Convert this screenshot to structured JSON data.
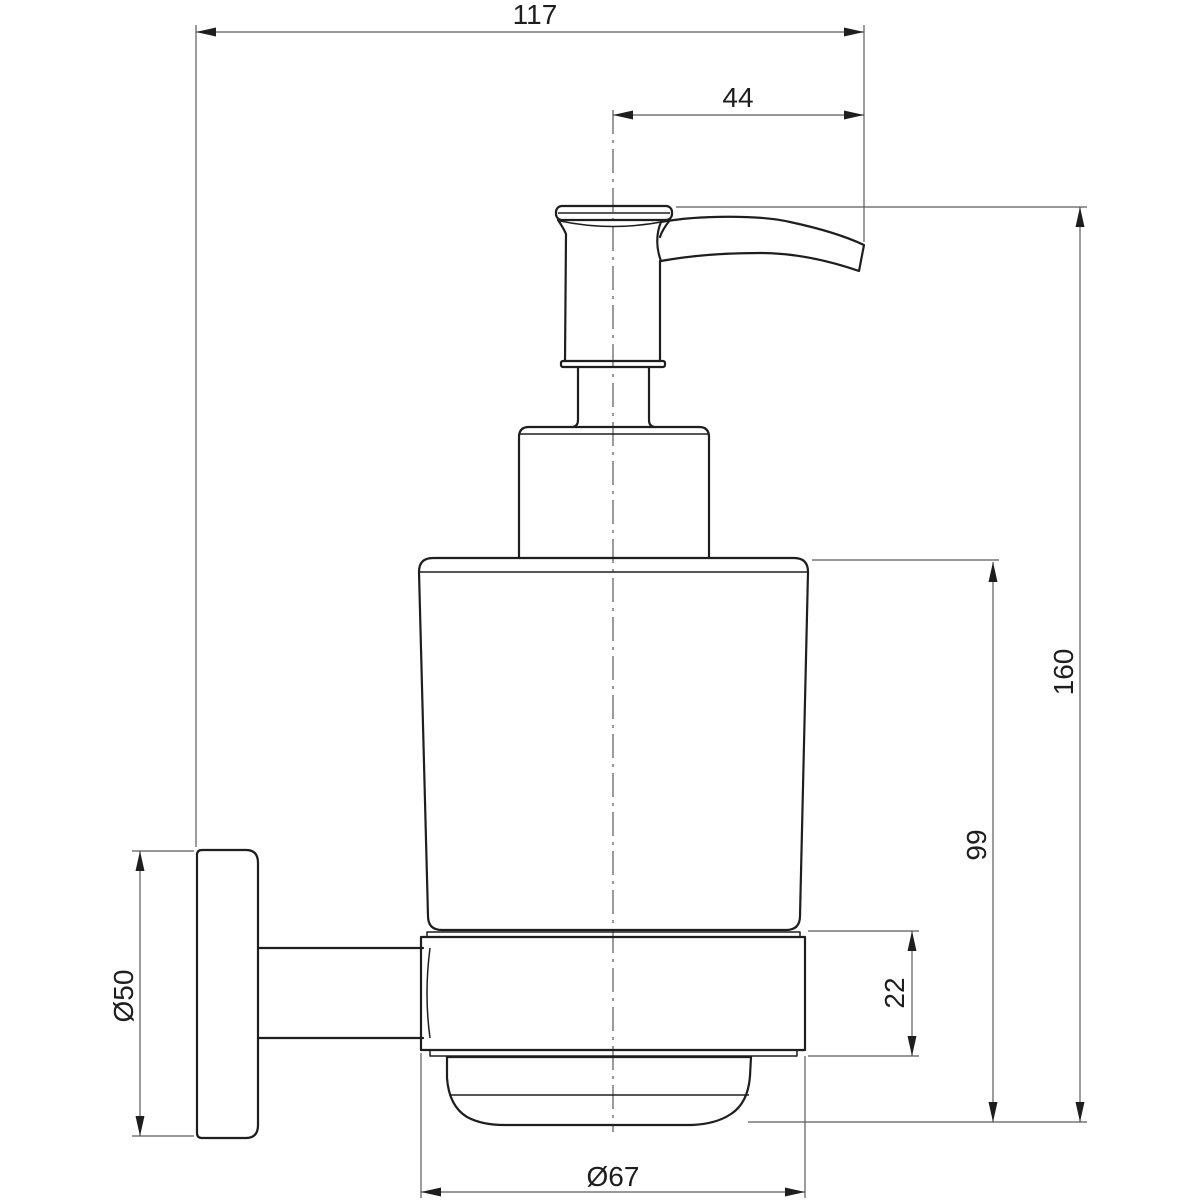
{
  "drawing": {
    "subject": "wall-mounted soap dispenser dimension drawing",
    "background": "#ffffff",
    "line_color": "#1e1e1e",
    "dim_line_color": "#5a5a5a",
    "dimensions": {
      "overall_width": "117",
      "spout_projection": "44",
      "overall_height": "160",
      "body_height": "99",
      "holder_ring_height": "22",
      "wall_plate_diameter": "Ø50",
      "glass_diameter": "Ø67"
    }
  }
}
